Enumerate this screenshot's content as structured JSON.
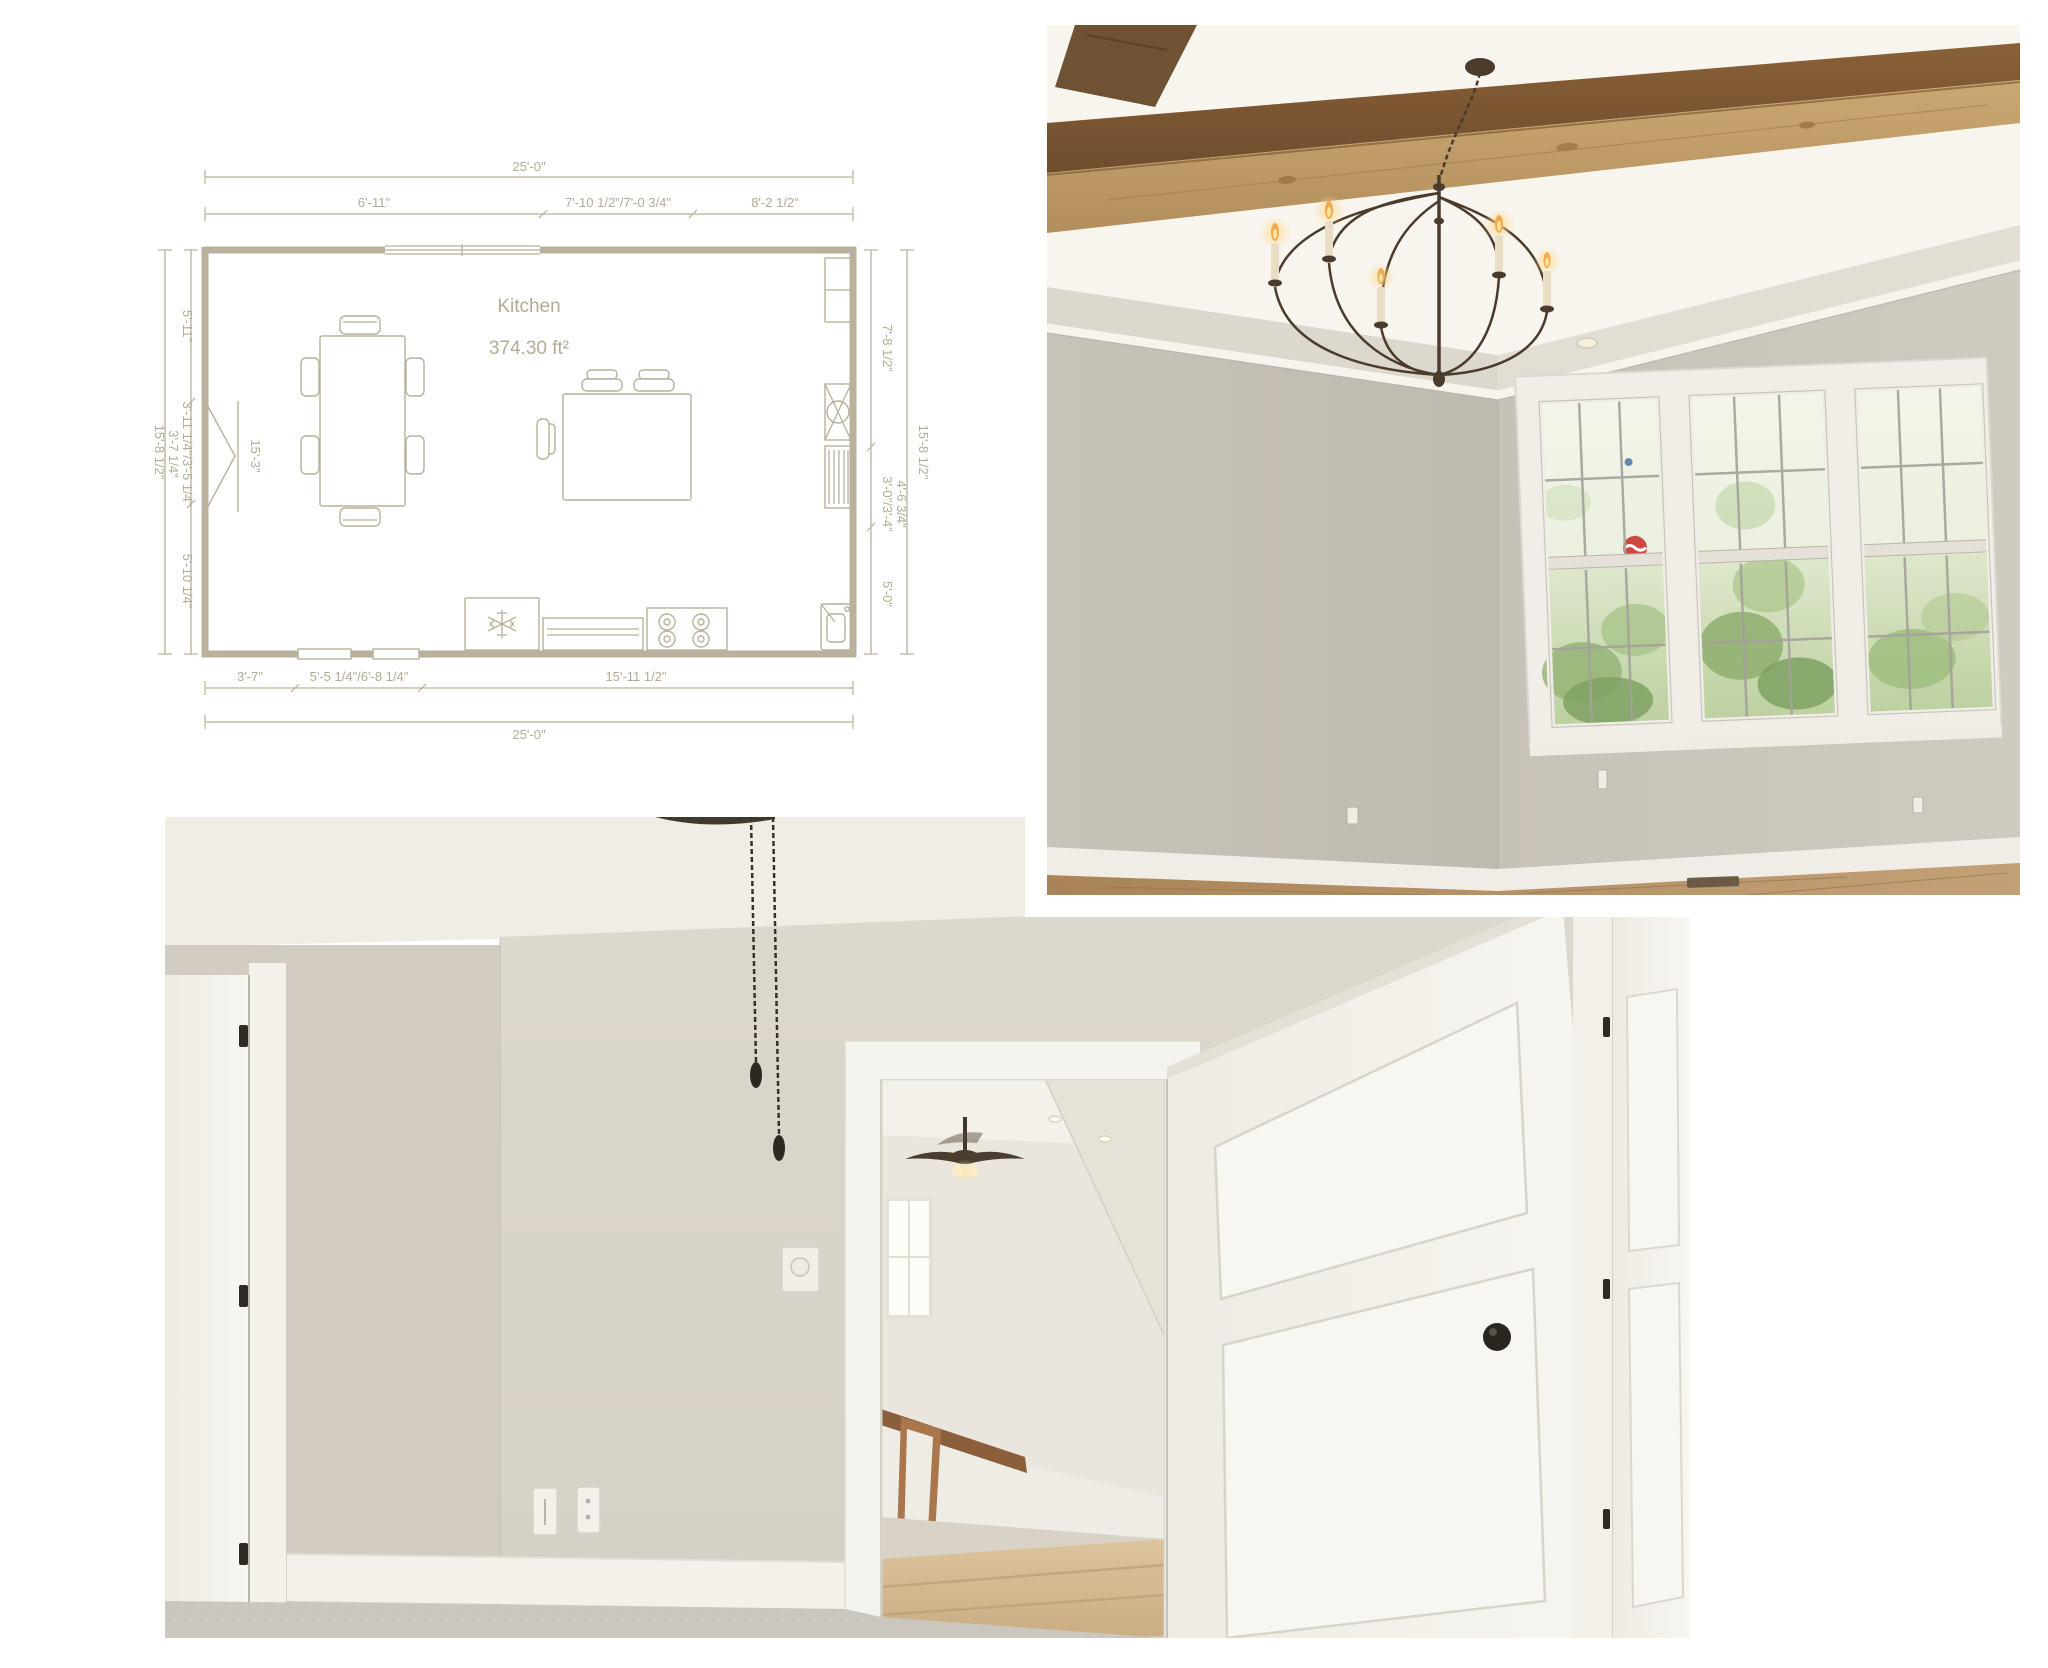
{
  "page": {
    "background": "#ffffff"
  },
  "floor_plan": {
    "room_label": "Kitchen",
    "room_area": "374.30 ft²",
    "colors": {
      "line": "#b9b19b",
      "text": "#b3ab95"
    },
    "dims": {
      "top_overall": "25'-0\"",
      "top_seg_1": "6'-11\"",
      "top_seg_2": "7'-10 1/2\"/7'-0 3/4\"",
      "top_seg_3": "8'-2 1/2\"",
      "bottom_seg_1": "3'-7\"",
      "bottom_seg_2": "5'-5 1/4\"/6'-8 1/4\"",
      "bottom_seg_3": "15'-11 1/2\"",
      "bottom_overall": "25'-0\"",
      "left_overall": "15'-8 1/2\"",
      "left_seg_1": "5'-11\"",
      "left_seg_2": "3'-11 1/4\"/3'-5 1/4\"",
      "left_seg_3": "3'-7 1/4\"",
      "left_seg_4": "5'-10 1/4\"",
      "right_overall": "15'-8 1/2\"",
      "right_seg_1": "7'-8 1/2\"",
      "right_seg_2": "3'-0\"/3'-4\"",
      "right_seg_3": "4'-6 3/4\"",
      "right_seg_4": "5'-0\"",
      "window_interior": "15'-3\""
    }
  },
  "photos": {
    "dining_room": {
      "wall": "#cac5bb",
      "beam": "#7d5c3b",
      "floor": "#b6905f",
      "foliage": "#8fae6e"
    },
    "bedroom": {
      "wall": "#d9d4ca",
      "carpet": "#ccc7be",
      "trim": "#f5f3ed",
      "stairs": "#d4ba92"
    }
  }
}
